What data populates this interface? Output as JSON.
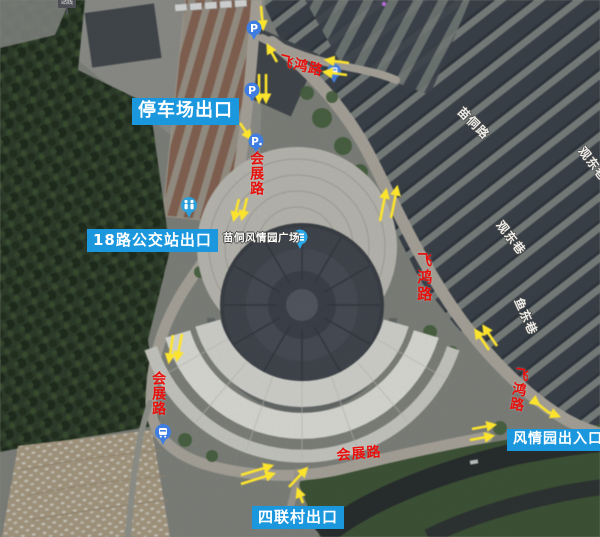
{
  "map": {
    "plaza_name": "苗侗风情园广场",
    "signpost_text": "站线",
    "parking_letter": "P",
    "exit_labels": [
      {
        "id": "parking-lot-exit",
        "text": "停车场出口"
      },
      {
        "id": "bus-18-station-exit",
        "text": "18路公交站出口"
      },
      {
        "id": "silian-village-exit",
        "text": "四联村出口"
      },
      {
        "id": "park-entrance-exit",
        "text": "风情园出入口"
      }
    ],
    "red_road_labels": [
      {
        "id": "feihong-road-top",
        "text": "飞鸿路"
      },
      {
        "id": "huizhan-road-west",
        "text": "会展路"
      },
      {
        "id": "feihong-road-east",
        "text": "飞鸿路"
      },
      {
        "id": "feihong-road-southeast",
        "text": "飞鸿路"
      },
      {
        "id": "huizhan-road-southwest",
        "text": "会展路"
      },
      {
        "id": "huizhan-road-south",
        "text": "会展路"
      }
    ],
    "white_street_labels": [
      {
        "id": "miaodong-road",
        "text": "苗侗路"
      },
      {
        "id": "guandong-lane",
        "text": "观东巷"
      },
      {
        "id": "yudong-lane",
        "text": "鱼东巷"
      },
      {
        "id": "edge-partial-lane",
        "text": "观东巷"
      }
    ],
    "icons": [
      {
        "name": "parking-icon",
        "glyph": "P"
      },
      {
        "name": "bus-station-icon",
        "glyph": "two-person pictogram"
      },
      {
        "name": "bus-stop-icon",
        "glyph": "bus pictogram"
      },
      {
        "name": "landmark-pin-icon",
        "glyph": "building pictogram"
      }
    ],
    "colors": {
      "exit_label_bg": "#1b97de",
      "red_label": "#e8100c",
      "arrow_yellow": "#ffe51e",
      "pin_blue": "#3f7de0"
    }
  }
}
